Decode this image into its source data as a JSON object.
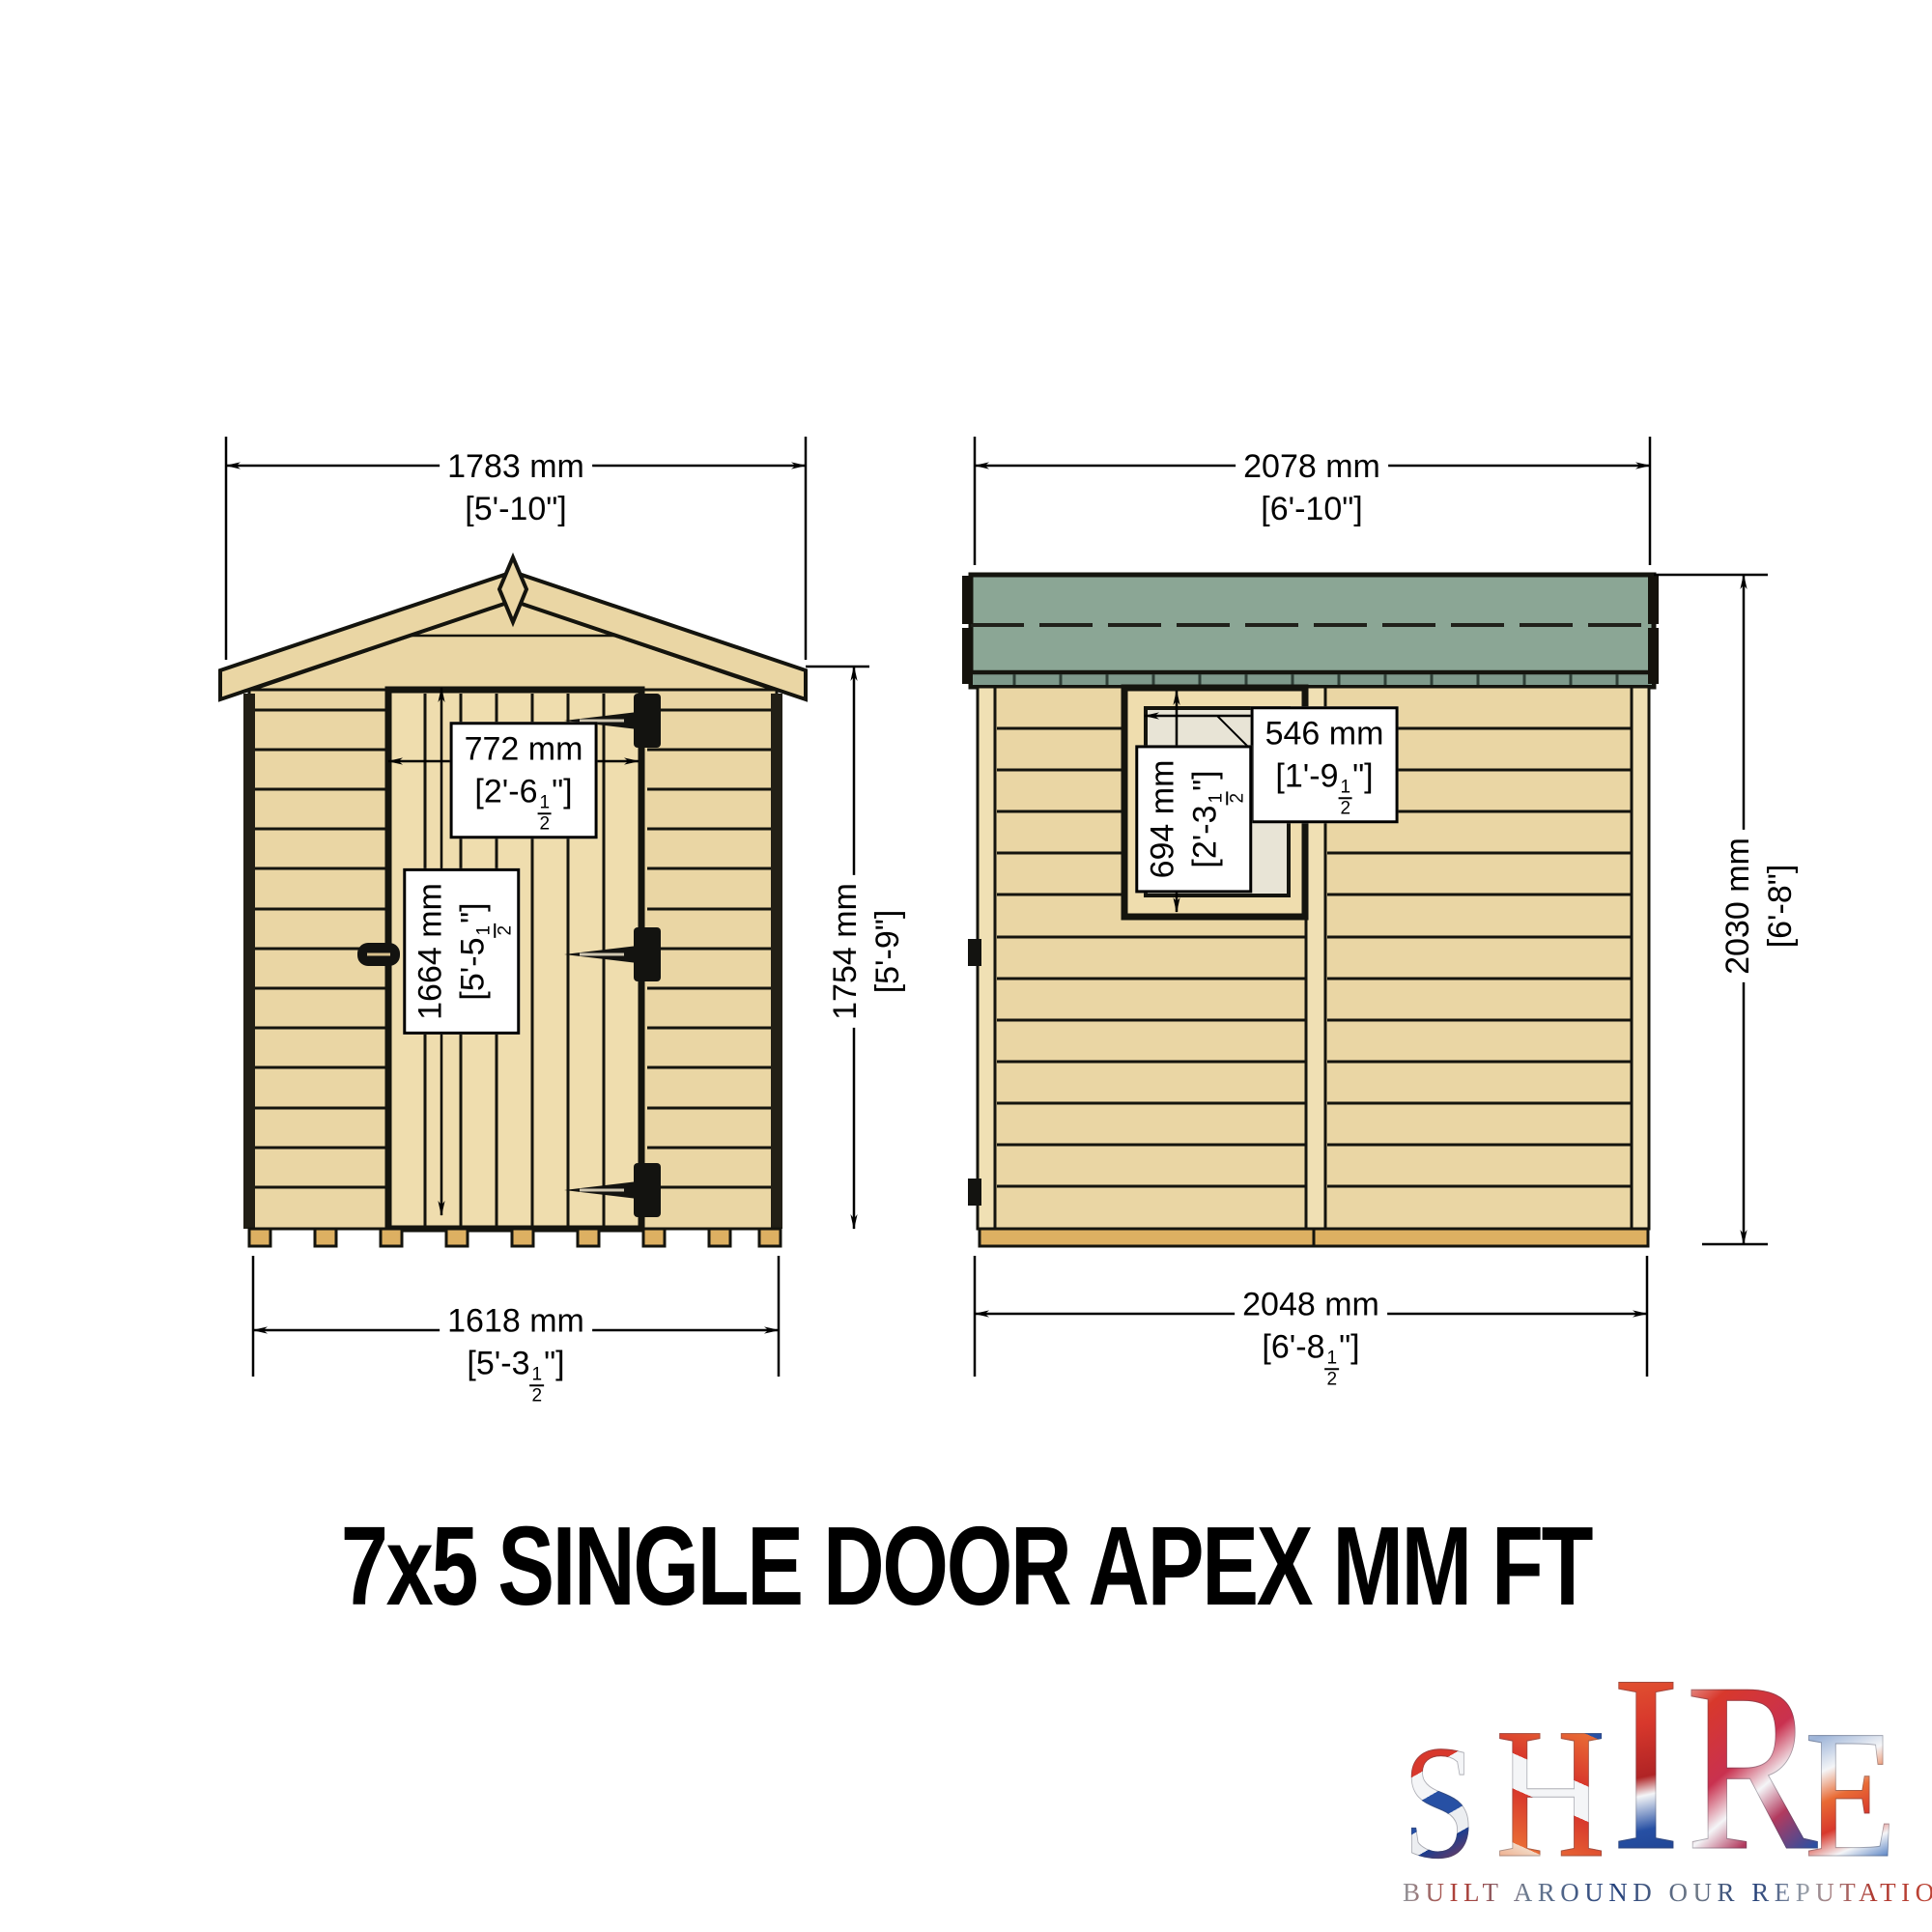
{
  "title": "7x5 SINGLE DOOR APEX MM FT",
  "front_view": {
    "label": "front elevation with single door",
    "dims": {
      "roof_width": {
        "mm": "1783 mm",
        "ftin": "[5'-10\"]"
      },
      "base_width": {
        "mm": "1618 mm",
        "ftin": "[5'-3½\"]"
      },
      "door_width": {
        "mm": "772 mm",
        "ftin": "[2'-6½\"]"
      },
      "door_height": {
        "mm": "1664 mm",
        "ftin": "[5'-5½\"]"
      },
      "eaves_height": {
        "mm": "1754 mm",
        "ftin": "[5'-9\"]"
      }
    }
  },
  "side_view": {
    "label": "side elevation with window",
    "dims": {
      "roof_length": {
        "mm": "2078 mm",
        "ftin": "[6'-10\"]"
      },
      "base_length": {
        "mm": "2048 mm",
        "ftin": "[6'-8½\"]"
      },
      "window_width": {
        "mm": "546 mm",
        "ftin": "[1'-9½\"]"
      },
      "window_height": {
        "mm": "694 mm",
        "ftin": "[2'-3½\"]"
      },
      "wall_height": {
        "mm": "2030 mm",
        "ftin": "[6'-8\"]"
      }
    }
  },
  "logo": {
    "letters": [
      "S",
      "H",
      "I",
      "R",
      "E"
    ],
    "tagline": "BUILT AROUND OUR REPUTATION"
  },
  "colors": {
    "wood": "#ead6a4",
    "wood_light": "#efddae",
    "trim": "#f0e0b4",
    "roof_green": "#8ba695",
    "roof_green_dark": "#7e998b",
    "glass": "#e8e4d6",
    "floor": "#ddb062",
    "outline": "#14140e"
  }
}
